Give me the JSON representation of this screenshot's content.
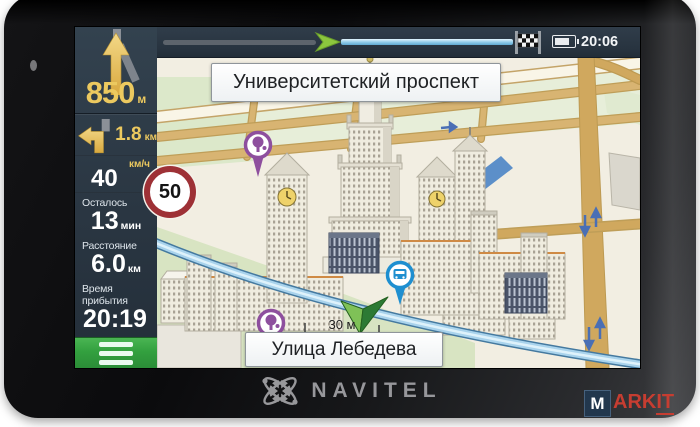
{
  "topbar": {
    "time": "20:06",
    "icons": {
      "finish": "checkered-flag",
      "battery": "battery-full",
      "position": "route-progress-arrow"
    }
  },
  "sidebar": {
    "maneuver_primary": {
      "icon": "arrow-straight",
      "distance": "850",
      "unit": "м"
    },
    "maneuver_next": {
      "icon": "arrow-turn-left",
      "distance": "1.8",
      "unit": "км"
    },
    "speed": {
      "unit_label": "км/ч",
      "current": "40",
      "limit": "50"
    },
    "info": [
      {
        "label": "Осталось",
        "value": "13",
        "unit": "мин"
      },
      {
        "label": "Расстояние",
        "value": "6.0",
        "unit": "км"
      },
      {
        "label": "Время прибытия",
        "value": "20:19",
        "unit": ""
      }
    ],
    "menu_icon": "hamburger"
  },
  "map": {
    "street_top": "Университетский проспект",
    "street_bottom": "Улица Лебедева",
    "scale_label": "30 м",
    "poi": {
      "tree_pin": "park-poi",
      "bus_pin": "transport-stop-poi",
      "marker": "position-arrow"
    }
  },
  "branding": {
    "logo_text": "NAVITEL"
  },
  "watermark": {
    "m": "M",
    "ark": "ARK",
    "it": "IT"
  },
  "colors": {
    "accent_gold": "#ecc95f",
    "button_green": "#33a03f",
    "route_blue": "#a9d3ec",
    "map_bg": "#f2eee2",
    "park_green": "#d8e4c2",
    "road_gold": "#d0a85e",
    "limit_red": "#9e3136",
    "poi_purple": "#8e4f9e",
    "poi_blue": "#1e8fd0",
    "marker_green": "#2c7a34",
    "panel_dark": "#2a3642"
  }
}
